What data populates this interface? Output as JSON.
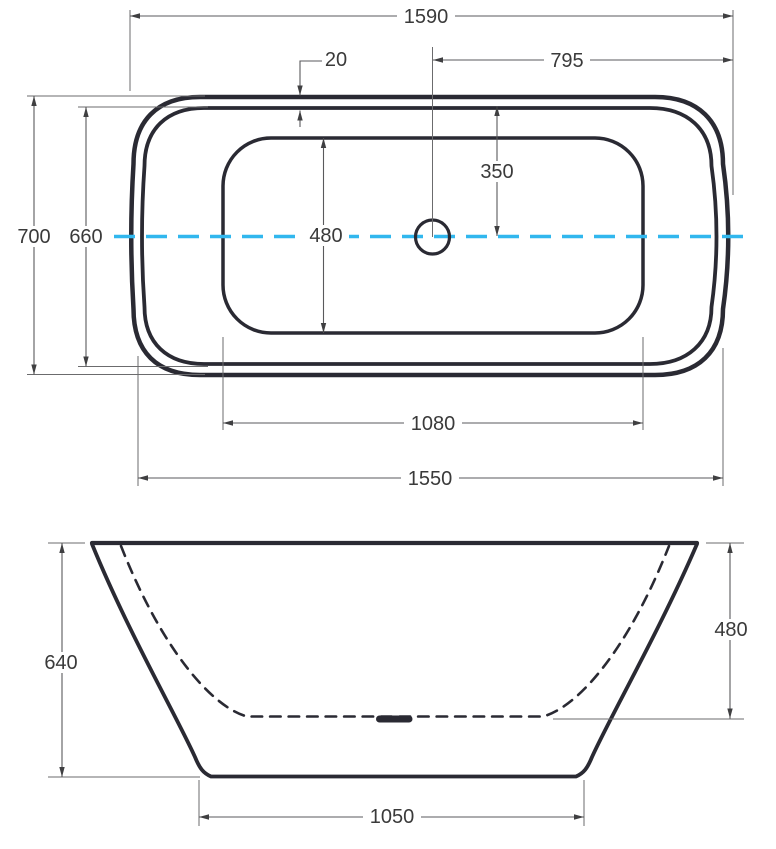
{
  "colors": {
    "outline": "#2a2a33",
    "dimension_lines": "#5a5a5c",
    "text": "#3a3a3a",
    "centerline": "#31b7ee"
  },
  "top_view": {
    "overall_width": "1590",
    "rim_width": "20",
    "center_to_right_edge": "795",
    "centerline_to_inner_rim_top": "350",
    "overall_depth": "700",
    "inner_rim_depth": "660",
    "basin_inner_width": "480",
    "basin_inner_length": "1080",
    "body_width_bottom": "1550"
  },
  "front_view": {
    "overall_height": "640",
    "interior_depth": "480",
    "base_width": "1050"
  }
}
